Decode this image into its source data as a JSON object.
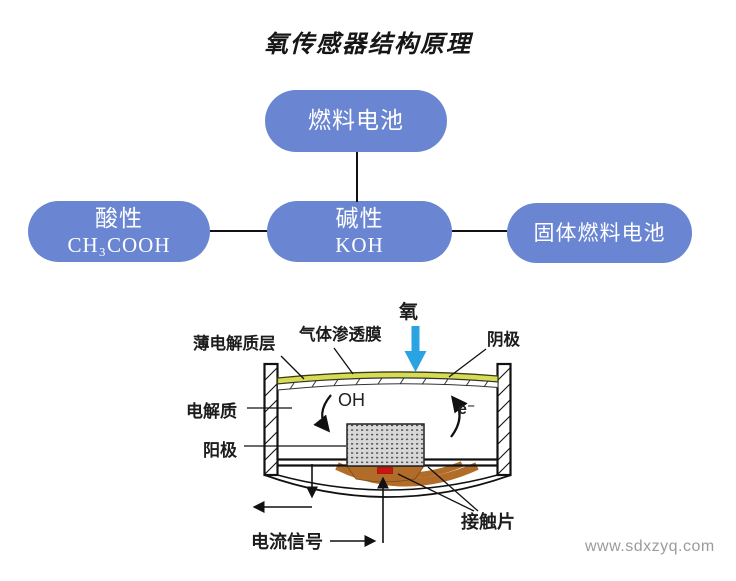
{
  "title": "氧传感器结构原理",
  "flowchart": {
    "box_color": "#6a85d1",
    "fuel_cell": "燃料电池",
    "acidic": {
      "line1": "酸性",
      "line2": "CH₃COOH"
    },
    "alkaline": {
      "line1": "碱性",
      "line2": "KOH"
    },
    "solid_fuel_cell": "固体燃料电池"
  },
  "sensor": {
    "oxygen": "氧",
    "thin_electrolyte_layer": "薄电解质层",
    "gas_permeable_membrane": "气体渗透膜",
    "cathode": "阴极",
    "electrolyte": "电解质",
    "anode": "阳极",
    "oh": "OH",
    "electron": "e⁻",
    "current_signal": "电流信号",
    "contact_piece": "接触片",
    "colors": {
      "membrane_yellow": "#d6dd55",
      "contact_brown": "#b06c28",
      "signal_red": "#cf1310",
      "oxygen_arrow_blue": "#2aa3e2",
      "anode_gray": "#d8d8d8"
    }
  },
  "watermark": "www.sdxzyq.com"
}
